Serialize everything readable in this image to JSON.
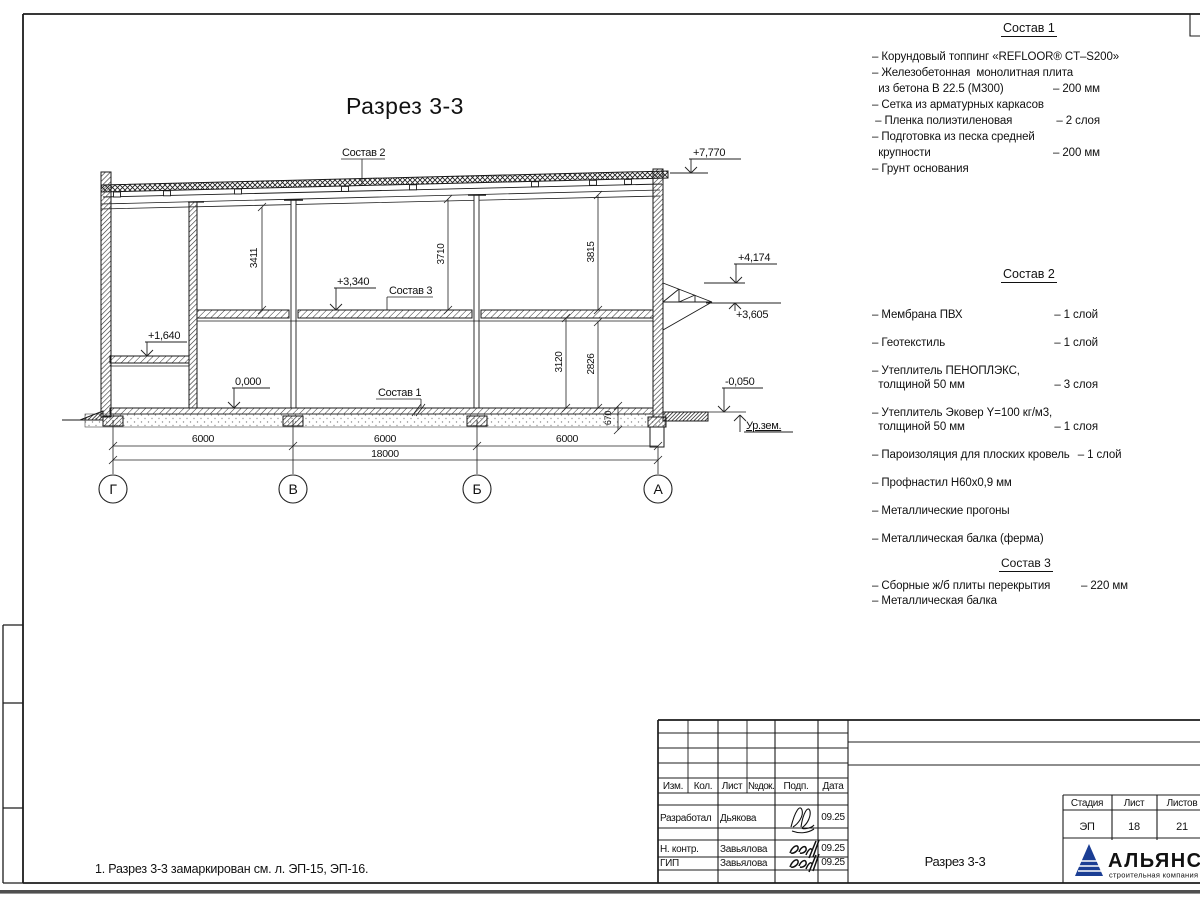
{
  "drawing": {
    "title": "Разрез 3-3",
    "axes": [
      "Г",
      "В",
      "Б",
      "А"
    ],
    "elevations": {
      "roof": "+7,770",
      "canopy_top": "+4,174",
      "canopy_bottom": "+3,605",
      "slab": "+3,340",
      "mezzanine": "+1,640",
      "floor": "0,000",
      "pavement": "-0,050",
      "ground": "Ур.зем."
    },
    "dims": {
      "v1": "3411",
      "v2": "3710",
      "v3": "3815",
      "v4": "3120",
      "v5": "2826",
      "v6": "670",
      "bay1": "6000",
      "bay2": "6000",
      "bay3": "6000",
      "total": "18000"
    },
    "callouts": {
      "sostav1": "Состав 1",
      "sostav2": "Состав 2",
      "sostav3": "Состав 3"
    }
  },
  "comps": [
    {
      "title": "Состав 1",
      "lines": [
        {
          "t": "– Корундовый топпинг «REFLOOR® CT–S200»",
          "v": ""
        },
        {
          "t": "– Железобетонная  монолитная плита",
          "v": ""
        },
        {
          "t": "  из бетона В 22.5 (М300)",
          "v": "– 200 мм"
        },
        {
          "t": "– Сетка из арматурных каркасов",
          "v": ""
        },
        {
          "t": " – Пленка полиэтиленовая",
          "v": "– 2 слоя"
        },
        {
          "t": "– Подготовка из песка средней",
          "v": ""
        },
        {
          "t": "  крупности",
          "v": "– 200 мм"
        },
        {
          "t": "– Грунт основания",
          "v": ""
        }
      ]
    },
    {
      "title": "Состав 2",
      "lines": [
        {
          "t": "– Мембрана ПВХ",
          "v": "– 1 слой"
        },
        {
          "t": "– Геотекстиль",
          "v": "– 1 слой"
        },
        {
          "t": "– Утеплитель ПЕНОПЛЭКС,",
          "v": ""
        },
        {
          "t": "  толщиной 50 мм",
          "v": "– 3 слоя"
        },
        {
          "t": "– Утеплитель Эковер Y=100 кг/м3,",
          "v": ""
        },
        {
          "t": "  толщиной 50 мм",
          "v": "– 1 слоя"
        },
        {
          "t": "– Пароизоляция для плоских кровель",
          "v": "– 1 слой"
        },
        {
          "t": "– Профнастил Н60х0,9 мм",
          "v": ""
        },
        {
          "t": "– Металлические прогоны",
          "v": ""
        },
        {
          "t": "– Металлическая балка (ферма)",
          "v": ""
        }
      ]
    },
    {
      "title": "Состав 3",
      "lines": [
        {
          "t": "– Сборные ж/б плиты перекрытия",
          "v": "– 220 мм"
        },
        {
          "t": "– Металлическая балка",
          "v": ""
        }
      ]
    }
  ],
  "note": "1. Разрез 3-3 замаркирован см. л. ЭП-15, ЭП-16.",
  "titleblock": {
    "headers": [
      "Изм.",
      "Кол.",
      "Лист",
      "№док.",
      "Подп.",
      "Дата"
    ],
    "rows": [
      {
        "role": "Разработал",
        "name": "Дьякова",
        "date": "09.25"
      },
      {
        "role": "Н. контр.",
        "name": "Завьялова",
        "date": "09.25"
      },
      {
        "role": "ГИП",
        "name": "Завьялова",
        "date": "09.25"
      }
    ],
    "doc_title": "Разрез 3-3",
    "stage_label": "Стадия",
    "sheet_label": "Лист",
    "sheets_label": "Листов",
    "stage": "ЭП",
    "sheet_no": "18",
    "sheets_total": "21",
    "logo": {
      "name": "АЛЬЯНС",
      "subtitle": "строительная компания",
      "color": "#1b3e94",
      "subtitle_color": "#42a0d8"
    }
  }
}
